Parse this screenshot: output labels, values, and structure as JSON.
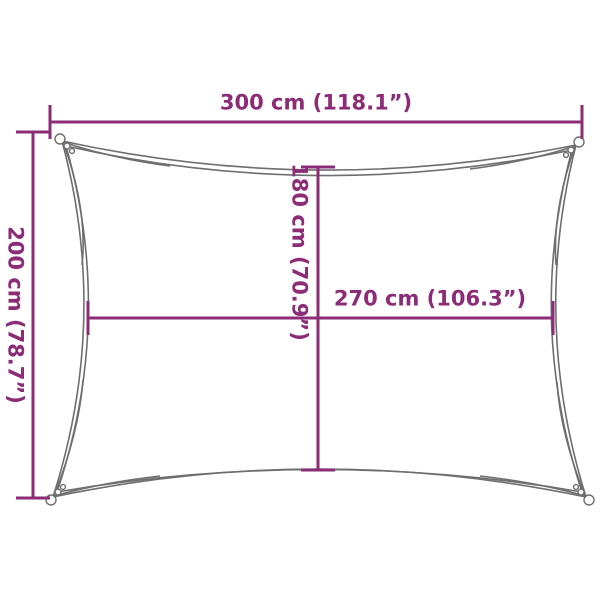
{
  "diagram": {
    "type": "product-dimension-diagram",
    "subject": "rectangular shade sail with concave edges and gathered corners",
    "labels": {
      "outer_width": "300 cm (118.1”)",
      "outer_height": "200 cm (78.7”)",
      "inner_height": "180 cm (70.9”)",
      "inner_width": "270 cm (106.3”)"
    },
    "values": {
      "outer_width_cm": 300,
      "outer_width_in": 118.1,
      "outer_height_cm": 200,
      "outer_height_in": 78.7,
      "inner_height_cm": 180,
      "inner_height_in": 70.9,
      "inner_width_cm": 270,
      "inner_width_in": 106.3
    },
    "colors": {
      "dimension": "#8C2B76",
      "sail_outline": "#6E6E6E",
      "background": "#FFFFFF"
    }
  }
}
